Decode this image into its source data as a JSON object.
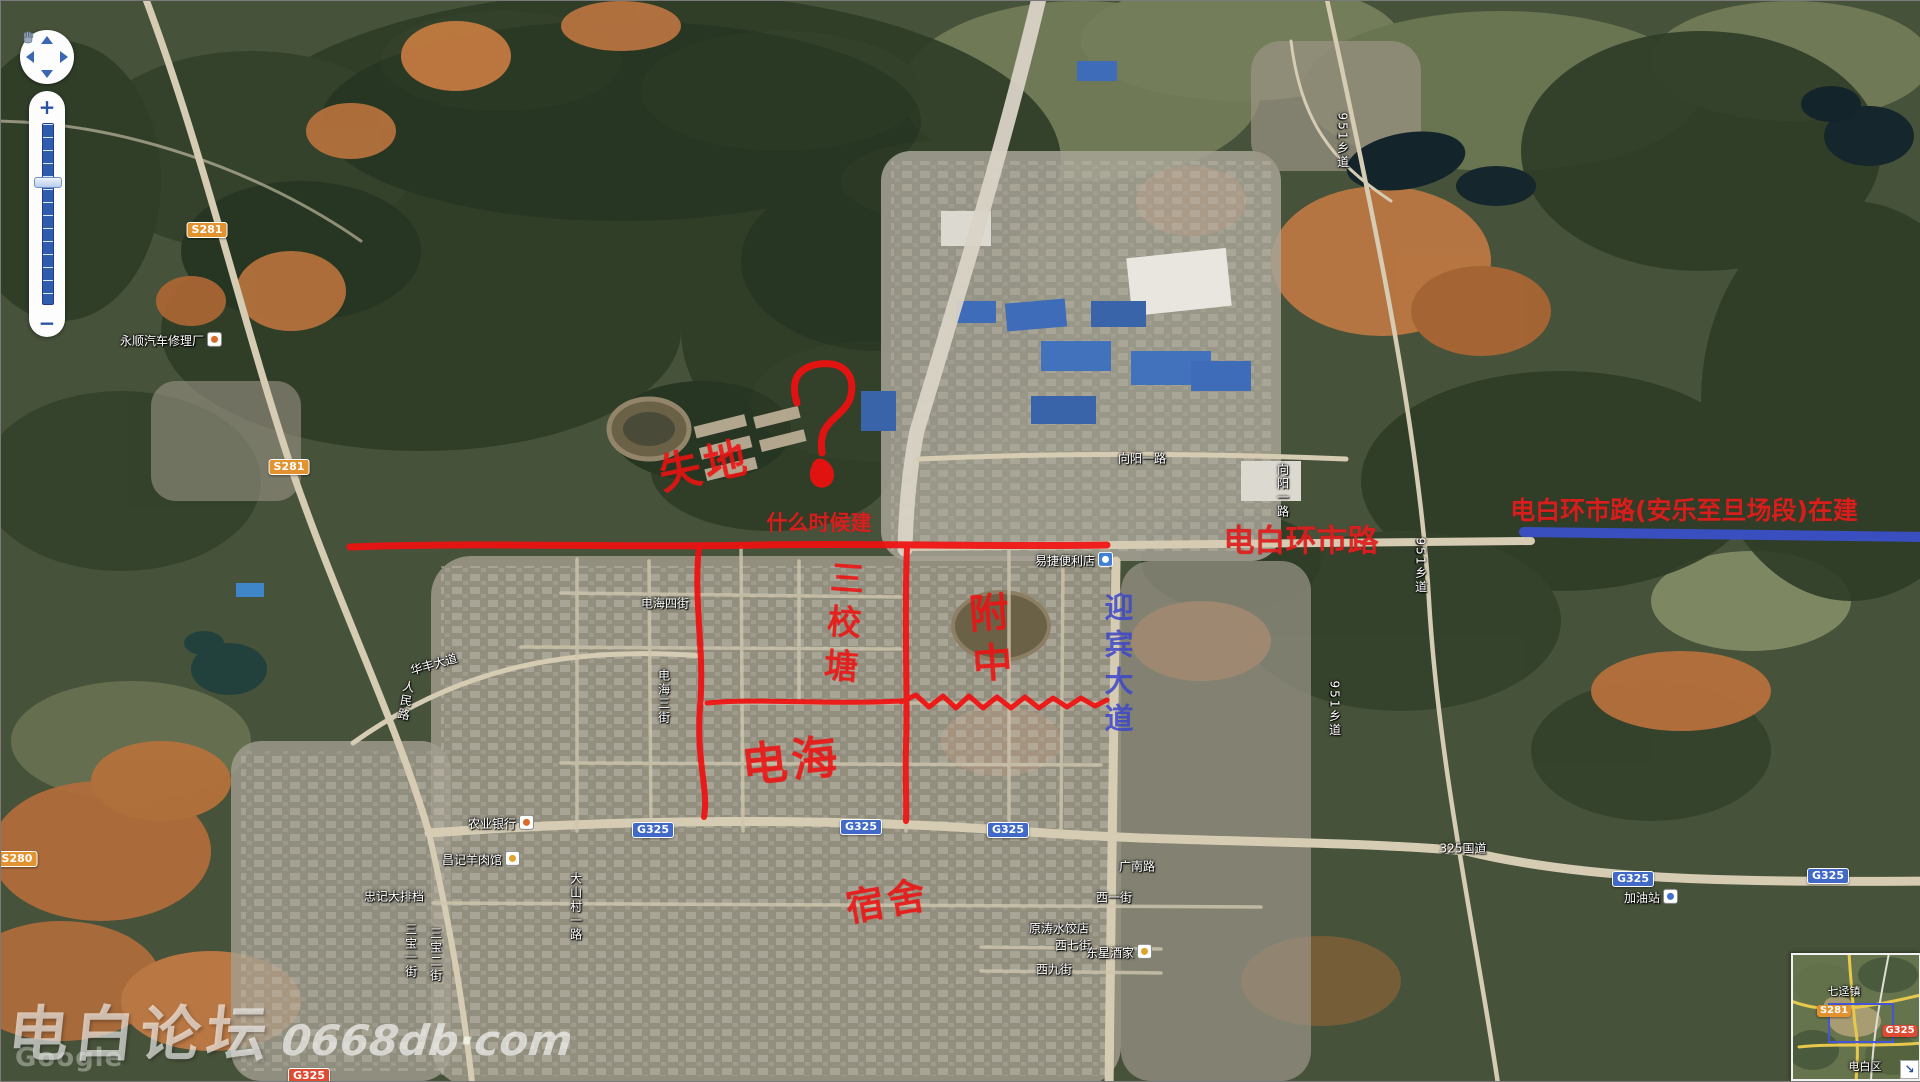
{
  "colors": {
    "ink_red": "#ee1212",
    "construction_blue": "#3a50c8",
    "label_white": "#ffffff",
    "badge_orange": "#e2922f",
    "badge_blue": "#4069c8",
    "badge_red": "#df4a32"
  },
  "map_controls": {
    "zoom_in_label": "+",
    "zoom_out_label": "−",
    "pan_directions": [
      "up",
      "left",
      "right",
      "down"
    ]
  },
  "map_labels": [
    {
      "name": "poi-yongshun-auto-repair",
      "text": "永顺汽车修理厂",
      "x": 170,
      "y": 339,
      "icon": "marker"
    },
    {
      "name": "badge-s281-north",
      "text": "S281",
      "x": 206,
      "y": 229,
      "style": "badge-orange"
    },
    {
      "name": "badge-s281-mid",
      "text": "S281",
      "x": 288,
      "y": 466,
      "style": "badge-orange"
    },
    {
      "name": "badge-s280",
      "text": "S280",
      "x": 16,
      "y": 858,
      "style": "badge-orange"
    },
    {
      "name": "road-huafeng-avenue",
      "text": "华丰大道",
      "x": 433,
      "y": 664,
      "rot": -16
    },
    {
      "name": "road-renmin-road",
      "text": "人民路",
      "x": 404,
      "y": 700,
      "vertical": true,
      "rot": 10
    },
    {
      "name": "road-dianhai-4th-street",
      "text": "电海四街",
      "x": 664,
      "y": 603
    },
    {
      "name": "road-dianhai-3rd-street",
      "text": "电海三街",
      "x": 662,
      "y": 696,
      "vertical": true
    },
    {
      "name": "poi-agricultural-bank",
      "text": "农业银行",
      "x": 500,
      "y": 822,
      "icon": "marker"
    },
    {
      "name": "poi-changji-mutton-restaurant",
      "text": "昌记羊肉馆",
      "x": 480,
      "y": 858,
      "icon": "food"
    },
    {
      "name": "poi-zhongji-food-stall",
      "text": "忠记大排档",
      "x": 393,
      "y": 896
    },
    {
      "name": "road-dashancun-1st-road",
      "text": "大山村一路",
      "x": 574,
      "y": 906,
      "vertical": true
    },
    {
      "name": "road-sanbao-1st-street",
      "text": "三宝一街",
      "x": 409,
      "y": 950,
      "vertical": true
    },
    {
      "name": "road-sanbao-2nd-street",
      "text": "三宝二街",
      "x": 434,
      "y": 954,
      "vertical": true
    },
    {
      "name": "road-guangnan-road",
      "text": "广南路",
      "x": 1136,
      "y": 866
    },
    {
      "name": "road-325-national",
      "text": "325国道",
      "x": 1462,
      "y": 848
    },
    {
      "name": "poi-gas-station",
      "text": "加油站",
      "x": 1650,
      "y": 896,
      "icon": "gas"
    },
    {
      "name": "road-xiangyang-1st-road",
      "text": "向阳一路",
      "x": 1141,
      "y": 458
    },
    {
      "name": "road-xiangyang-1st-road-v",
      "text": "向阳一路",
      "x": 1281,
      "y": 490,
      "vertical": true
    },
    {
      "name": "road-951-township-north",
      "text": "951乡道",
      "x": 1341,
      "y": 140,
      "vertical": true
    },
    {
      "name": "road-951-township-mid",
      "text": "951乡道",
      "x": 1419,
      "y": 565,
      "vertical": true
    },
    {
      "name": "road-951-township-south",
      "text": "951乡道",
      "x": 1333,
      "y": 708,
      "vertical": true
    },
    {
      "name": "poi-yijie-convenience-store",
      "text": "易捷便利店",
      "x": 1073,
      "y": 559,
      "icon": "store"
    },
    {
      "name": "poi-yuantao-dumpling-shop",
      "text": "原涛水饺店",
      "x": 1058,
      "y": 928
    },
    {
      "name": "road-xi-7th-street",
      "text": "西七街",
      "x": 1072,
      "y": 945
    },
    {
      "name": "poi-dongxing-restaurant",
      "text": "东星酒家",
      "x": 1118,
      "y": 951,
      "icon": "food"
    },
    {
      "name": "road-xi-9th-street",
      "text": "西九街",
      "x": 1053,
      "y": 969
    },
    {
      "name": "road-xi-1st-street",
      "text": "西一街",
      "x": 1113,
      "y": 897
    },
    {
      "name": "badge-g325-1",
      "text": "G325",
      "x": 652,
      "y": 829,
      "style": "badge-blue"
    },
    {
      "name": "badge-g325-2",
      "text": "G325",
      "x": 860,
      "y": 826,
      "style": "badge-blue"
    },
    {
      "name": "badge-g325-3",
      "text": "G325",
      "x": 1007,
      "y": 829,
      "style": "badge-blue"
    },
    {
      "name": "badge-g325-4",
      "text": "G325",
      "x": 1632,
      "y": 878,
      "style": "badge-blue"
    },
    {
      "name": "badge-g325-5",
      "text": "G325",
      "x": 1827,
      "y": 875,
      "style": "badge-blue"
    },
    {
      "name": "badge-g325-bottom",
      "text": "G325",
      "x": 308,
      "y": 1075,
      "style": "badge-red"
    }
  ],
  "annotations": {
    "typed_texts": [
      {
        "name": "note-when-built",
        "text": "什么时候建",
        "x": 818,
        "y": 521,
        "size": 21
      },
      {
        "name": "label-huanshi-road-red",
        "text": "电白环市路",
        "x": 1300,
        "y": 537,
        "size": 31
      },
      {
        "name": "label-huanshi-under-construction",
        "text": "电白环市路(安乐至旦场段)在建",
        "x": 1683,
        "y": 508,
        "size": 25
      }
    ],
    "handwritten_texts": [
      {
        "name": "scribble-shidi",
        "text": "失地",
        "x": 703,
        "y": 462,
        "size": 42,
        "rot": -12
      },
      {
        "name": "scribble-sanxiaotang",
        "text": "三校塘",
        "x": 840,
        "y": 625,
        "size": 34,
        "vertical": true,
        "rot": 4
      },
      {
        "name": "scribble-fuzhong",
        "text": "附中",
        "x": 986,
        "y": 641,
        "size": 40,
        "vertical": true,
        "rot": -4
      },
      {
        "name": "scribble-dianhai",
        "text": "电海",
        "x": 790,
        "y": 757,
        "size": 46,
        "rot": -6
      },
      {
        "name": "scribble-sushe",
        "text": "宿舍",
        "x": 886,
        "y": 897,
        "size": 38,
        "rot": -10
      }
    ],
    "blue_texts": [
      {
        "name": "label-yingbin-avenue",
        "text": "迎宾大道",
        "x": 1116,
        "y": 665,
        "size": 29
      }
    ],
    "drawn_shapes": [
      {
        "name": "red-line-huanshi-existing",
        "desc": "hand-drawn red line along ring road, west half"
      },
      {
        "name": "red-line-vertical-west",
        "desc": "hand-drawn red vertical street line"
      },
      {
        "name": "red-line-vertical-east",
        "desc": "hand-drawn red vertical street line"
      },
      {
        "name": "red-line-horizontal-south",
        "desc": "hand-drawn red wavy line along east-west street"
      },
      {
        "name": "red-question-mark",
        "desc": "hand-drawn red question mark over woodland"
      },
      {
        "name": "blue-line-planned-road",
        "desc": "thick blue line for road section under construction"
      }
    ]
  },
  "watermark": {
    "forum_name": "电白论坛",
    "site": "0668db·com",
    "map_credit": "Google"
  },
  "minimap": {
    "town_label": "七迳镇",
    "district_label": "电白区",
    "badge_s281": "S281",
    "badge_g325": "G325",
    "resize_glyph": "↘"
  }
}
